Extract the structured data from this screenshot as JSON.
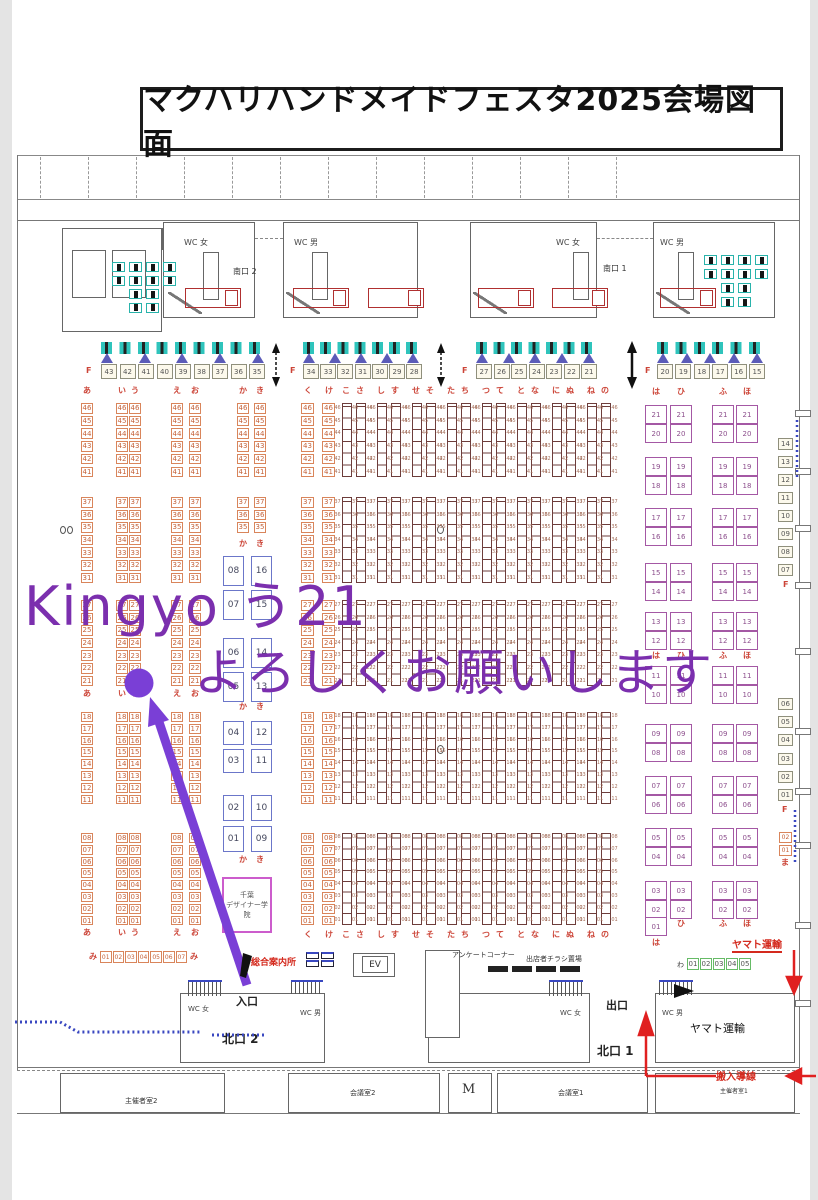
{
  "title": "マクハリハンドメイドフェスタ2025会場図面",
  "annotation": {
    "line1": "Kingyo う21",
    "line2": "よろしくお願いします",
    "color": "#7b2fae",
    "marker_color": "#7a3fd6",
    "target_booth": "う21"
  },
  "f_row": {
    "label": "F",
    "groups": [
      [
        "43",
        "42",
        "41",
        "40",
        "39",
        "38",
        "37",
        "36",
        "35"
      ],
      [
        "34",
        "33",
        "32",
        "31",
        "30",
        "29",
        "28"
      ],
      [
        "27",
        "26",
        "25",
        "24",
        "23",
        "22",
        "21"
      ],
      [
        "20",
        "19",
        "18",
        "17",
        "16",
        "15"
      ]
    ]
  },
  "block_rows": [
    [
      "46",
      "45",
      "44",
      "43",
      "42",
      "41"
    ],
    [
      "37",
      "36",
      "35",
      "34",
      "33",
      "32",
      "31"
    ],
    [
      "27",
      "26",
      "25",
      "24",
      "23",
      "22",
      "21"
    ],
    [
      "18",
      "17",
      "16",
      "15",
      "14",
      "13",
      "12",
      "11"
    ],
    [
      "08",
      "07",
      "06",
      "05",
      "04",
      "03",
      "02",
      "01"
    ]
  ],
  "sections": {
    "left": {
      "columns": [
        "あ",
        "い",
        "う",
        "え",
        "お"
      ]
    },
    "kaki": {
      "columns": [
        "か",
        "き"
      ],
      "upper_blocks": [
        [
          "46",
          "45",
          "44",
          "43",
          "42",
          "41"
        ],
        [
          "37",
          "36",
          "35"
        ]
      ],
      "blue_pairs_a": [
        [
          "08",
          "16"
        ],
        [
          "07",
          "15"
        ],
        [
          "06",
          "14"
        ],
        [
          "05",
          "13"
        ]
      ],
      "blue_pairs_b": [
        [
          "04",
          "12"
        ],
        [
          "03",
          "11"
        ]
      ],
      "blue_pairs_c": [
        [
          "02",
          "10"
        ],
        [
          "01",
          "09"
        ]
      ]
    },
    "center": {
      "box_columns": [
        "く",
        "け"
      ],
      "strip_pairs": [
        [
          "こ",
          "さ"
        ],
        [
          "し",
          "す"
        ],
        [
          "せ",
          "そ"
        ],
        [
          "た",
          "ち"
        ],
        [
          "つ",
          "て"
        ],
        [
          "と",
          "な"
        ],
        [
          "に",
          "ぬ"
        ],
        [
          "ね",
          "の"
        ]
      ]
    },
    "purple": {
      "columns": [
        "は",
        "ひ",
        "ふ",
        "ほ"
      ],
      "upper_pairs": [
        [
          "21",
          "20"
        ],
        [
          "19",
          "18"
        ],
        [
          "17",
          "16"
        ],
        [
          "15",
          "14"
        ],
        [
          "13",
          "12"
        ]
      ],
      "lower_pairs": [
        [
          "11",
          "10"
        ],
        [
          "09",
          "08"
        ],
        [
          "07",
          "06"
        ],
        [
          "05",
          "04"
        ],
        [
          "03",
          "02"
        ]
      ],
      "last": "01"
    },
    "right_f": {
      "label": "F",
      "upper": [
        "14",
        "13",
        "12",
        "11",
        "10",
        "09",
        "08",
        "07"
      ],
      "lower": [
        "06",
        "05",
        "04",
        "03",
        "02",
        "01"
      ],
      "ma_label": "ま",
      "ma": [
        "02",
        "01"
      ]
    }
  },
  "rows": {
    "mi": {
      "label": "み",
      "numbers": [
        "01",
        "02",
        "03",
        "04",
        "05",
        "06",
        "07"
      ]
    },
    "wa": {
      "label": "わ",
      "numbers": [
        "01",
        "02",
        "03",
        "04",
        "05"
      ]
    }
  },
  "labels": {
    "south_gate_2": "南口 2",
    "south_gate_1": "南口 1",
    "wc_women": "WC 女",
    "wc_men": "WC 男",
    "entrance": "入口",
    "exit": "出口",
    "north_gate_2": "北口 2",
    "north_gate_1": "北口 1",
    "info_desk": "総合案内所",
    "ev": "EV",
    "survey_corner": "アンケートコーナー",
    "flyer_rack": "出店者チラシ置場",
    "yamato_route": "ヤマト運輸",
    "yamato_room": "ヤマト運輸",
    "carry_in_route": "搬入導線",
    "school_line1": "千葉",
    "school_line2": "デザイナー学院",
    "organizer_room_2": "主催者室2",
    "organizer_room_1": "主催者室1",
    "meeting_room_2": "会議室2",
    "meeting_room_1": "会議室1",
    "m_room": "M"
  },
  "colors": {
    "booth_orange": "#d9855b",
    "booth_purple": "#a458a4",
    "strip_brown": "#6d3d3b",
    "header_red": "#cc4437",
    "teal_table": "#2fc4bc",
    "truck_red": "#b03030",
    "route_blue": "#3947c0",
    "arrow_red": "#e02020"
  }
}
